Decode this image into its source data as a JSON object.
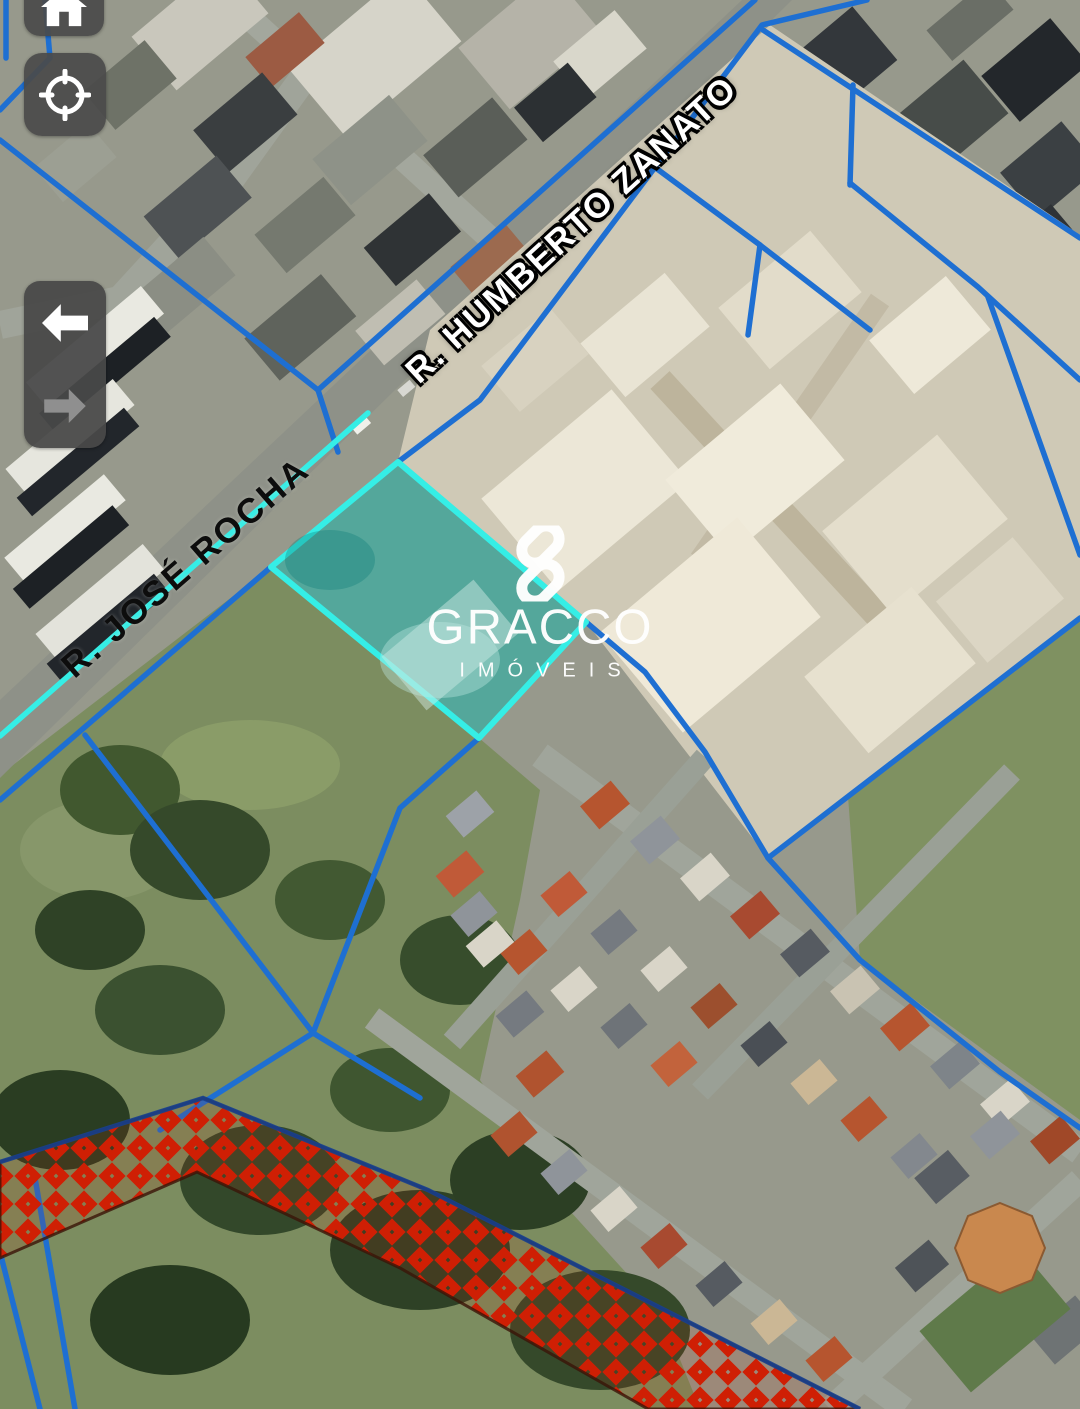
{
  "map_overlay": {
    "street_labels": [
      {
        "id": "humberto",
        "text": "R. HUMBERTO ZANATO"
      },
      {
        "id": "jose_rocha",
        "text": "R. JOSÉ ROCHA"
      }
    ],
    "watermark": {
      "brand": "GRACCO",
      "tagline": "IMÓVEIS"
    },
    "highlighted_parcel": {
      "shape": "rotated-rectangle",
      "position": "center-left of map"
    },
    "restricted_zone": {
      "style": "red-crosshatch-band",
      "position": "bottom"
    },
    "colors": {
      "parcel_line_blue": "#1e6fd2",
      "highlight_cyan": "#35eee6",
      "highlight_fill_teal": "#12b5aa",
      "restricted_red": "#cf1f04",
      "control_background": "#4a4a4a"
    }
  },
  "controls": {
    "home_button": {
      "icon": "home-icon"
    },
    "locate_button": {
      "icon": "locate-icon"
    },
    "nav_back": {
      "icon": "arrow-left-icon",
      "enabled": true
    },
    "nav_forward": {
      "icon": "arrow-right-icon",
      "enabled": false
    }
  }
}
